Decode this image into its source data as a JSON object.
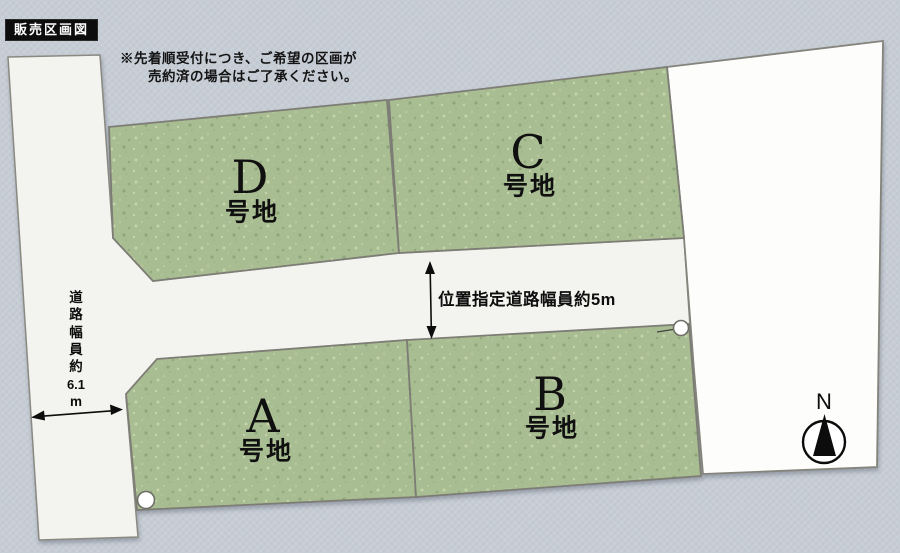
{
  "badge": {
    "label": "販売区画図"
  },
  "notice": {
    "line1": "※先着順受付につき、ご希望の区画が",
    "line2": "売約済の場合はご了承ください。"
  },
  "plots": {
    "d": {
      "letter": "D",
      "suffix": "号地"
    },
    "c": {
      "letter": "C",
      "suffix": "号地"
    },
    "a": {
      "letter": "A",
      "suffix": "号地"
    },
    "b": {
      "letter": "B",
      "suffix": "号地"
    }
  },
  "roads": {
    "horizontal_label": "位置指定道路幅員約5m",
    "left_label": "道路幅員約6.1m",
    "left_chars": [
      "道",
      "路",
      "幅",
      "員",
      "約",
      "6.1",
      "m"
    ]
  },
  "compass": {
    "label": "N"
  },
  "colors": {
    "background": "#c7cdd5",
    "plot_green": "#a9bd92",
    "road_white": "#f3f3ef",
    "vacant_lot": "#fdfdfc",
    "outline": "#82827a",
    "ink": "#111111"
  }
}
